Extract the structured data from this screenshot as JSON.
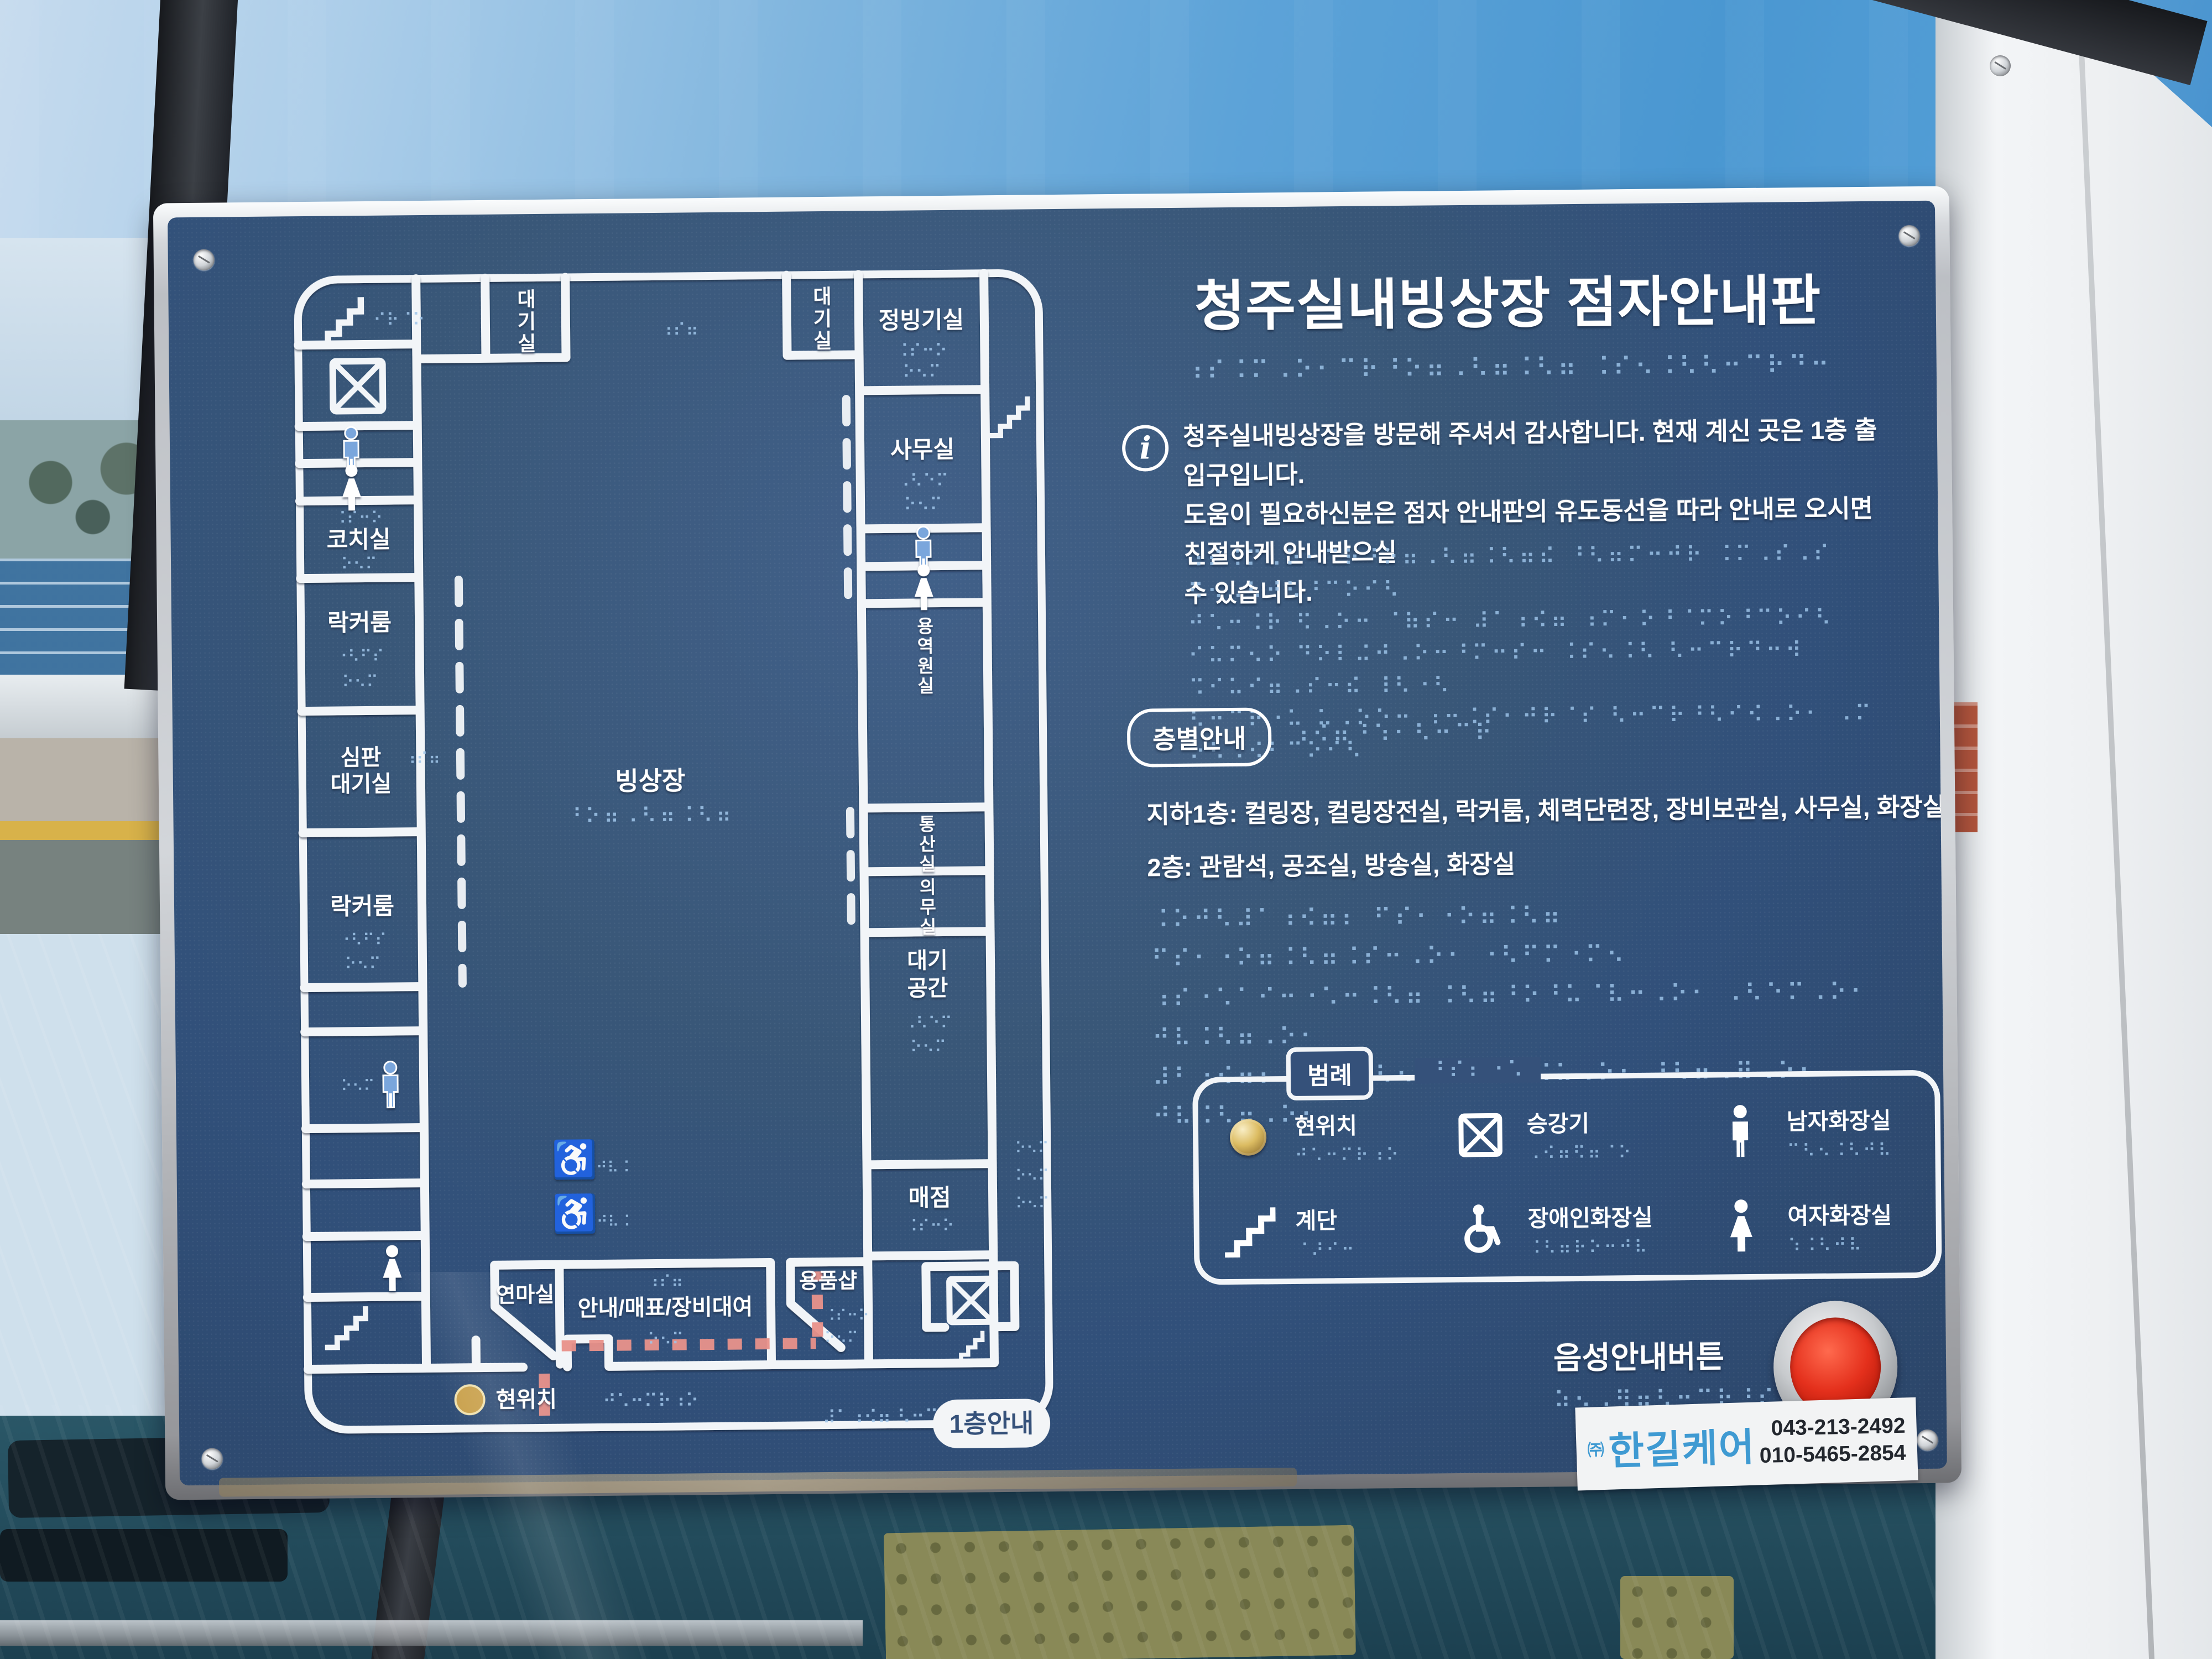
{
  "colors": {
    "panel_navy": "#35517a",
    "wall_white": "#f2f5f8",
    "braille_blue": "#9cc2e8",
    "path_pink": "#e8918a",
    "button_red": "#d92615",
    "gold": "#caa24e",
    "sticker_blue": "#3f9ad2"
  },
  "board": {
    "title": "청주실내빙상장 점자안내판",
    "title_braille": "⠰⠎⠨⠍⠠⠕⠂⠉⠗⠘⠕⠶⠠⠣⠶⠨⠣⠶ ⠨⠎⠢⠨⠣⠣⠒⠉⠗⠙⠒",
    "info": {
      "line1": "청주실내빙상장을 방문해 주셔서 감사합니다. 현재 계신 곳은 1층 출입구입니다.",
      "line2": "도움이 필요하신분은 점자 안내판의 유도동선을 따라 안내로 오시면 친절하게 안내받으실",
      "line3": "수 있습니다.",
      "braille1": "⠰⠎⠨⠍⠠⠕⠂⠉⠗⠘⠕⠶⠠⠣⠶⠨⠣⠶⠮ ⠘⠣⠶⠍⠒⠚⠗ ⠨⠍⠠⠎⠠⠎ ⠫⠢⠠⠣⠚⠣⠘⠉⠕⠊⠣",
      "braille2": "⠚⠡⠒⠨⠗ ⠫⠠⠕⠒ ⠈⠷⠎⠒ ⠼⠁⠰⠪⠶ ⠰⠍⠂⠕⠘⠈⠍⠕⠘⠉⠕⠊⠣",
      "braille3": "⠊⠥⠍⠢⠕ ⠙⠕⠇⠬⠚⠠⠕⠒⠘⠍⠒⠎⠒ ⠨⠎⠢⠨⠣ ⠣⠒⠉⠗⠙⠒⠺ ⠩⠊⠥⠊⠶⠠⠎⠒⠮ ⠸⠣⠐⠣",
      "braille4": "⠣⠒⠉⠗⠐⠥ ⠥⠠⠕⠑⠒ ⠰⠒⠨⠎⠂⠚⠗⠈⠎ ⠣⠒⠉⠗⠘⠣⠊⠪⠠⠕⠂ ⠠⠍ ⠕⠣⠠⠪⠃⠉⠕⠊⠣"
    },
    "floors": {
      "pill": "층별안내",
      "pill_braille": "⠰⠪⠶⠘⠱⠂⠣⠒⠉⠗",
      "line1": "지하1층: 컬링장, 컬링장전실, 락커룸, 체력단련장, 장비보관실, 사무실, 화장실",
      "line2": "2층: 관람석, 공조실, 방송실, 화장실",
      "braille1": "⠨⠕⠚⠣⠼⠁⠰⠪⠶⠆ ⠋⠎⠂⠐⠕⠶⠨⠣⠶ ⠋⠎⠂⠐⠕⠶⠨⠣⠶⠨⠎⠒⠠⠕⠂ ⠐⠣⠋⠍⠐⠍⠢",
      "braille2": "⠰⠎⠐⠡⠁⠊⠒⠐⠡⠒⠨⠣⠶ ⠨⠣⠶⠘⠕⠘⠥⠈⠧⠒⠠⠕⠂ ⠠⠣⠑⠍⠠⠕⠂ ⠚⠧⠨⠣⠶⠠⠕⠂",
      "braille3": "⠼⠃⠰⠪⠶⠆ ⠈⠧⠒⠐⠣⠢⠠⠎⠁ ⠈⠿⠨⠥⠠⠕⠂ ⠘⠣⠶⠠⠿⠠⠕⠂ ⠚⠧⠨⠣⠶⠠⠕⠂"
    },
    "legend": {
      "title": "범례",
      "title_braille": "⠘⠎⠆⠐⠡",
      "items": [
        {
          "icon": "current-location-button",
          "label": "현위치",
          "braille": "⠚⠡⠒⠍⠗⠰⠕"
        },
        {
          "icon": "elevator-icon",
          "label": "승강기",
          "braille": "⠠⠪⠶⠫⠶⠈⠕"
        },
        {
          "icon": "male-restroom-icon",
          "label": "남자화장실",
          "braille": "⠉⠣⠢⠨⠣⠚⠧"
        },
        {
          "icon": "stairs-icon",
          "label": "계단",
          "braille": "⠈⠜⠊⠒"
        },
        {
          "icon": "accessible-restroom-icon",
          "label": "장애인화장실",
          "braille": "⠨⠣⠶⠗⠕⠒⠚⠧"
        },
        {
          "icon": "female-restroom-icon",
          "label": "여자화장실",
          "braille": "⠱⠨⠣⠚⠧"
        }
      ]
    },
    "voice": {
      "label": "음성안내버튼",
      "braille": "⠵⠢⠠⠻⠶⠣⠒⠉⠗⠘⠎⠊⠵⠒"
    },
    "sticker": {
      "prefix": "㈜",
      "company": "한길케어",
      "phone1": "043-213-2492",
      "phone2": "010-5465-2854"
    }
  },
  "map": {
    "pill": "1층안내",
    "current": "현위치",
    "current_braille": "⠚⠡⠒⠍⠗⠰⠕",
    "bottom_braille": "⠼⠁⠰⠪⠶ ⠣⠒⠉⠗ ⠊⠗⠈⠕",
    "rink": "빙상장",
    "rink_braille": "⠘⠕⠶⠠⠣⠶⠨⠣⠶",
    "labels": {
      "waiting1": "대기실",
      "waiting2": "대기실",
      "resurfacing": "정빙기실",
      "office": "사무실",
      "coach": "코치실",
      "locker1": "락커룸",
      "referee1": "심판",
      "referee2": "대기실",
      "locker2": "락커룸",
      "service": "용역원실",
      "comms": "통산실",
      "medical": "의무실",
      "wait1": "대기",
      "wait2": "공간",
      "snack": "매점",
      "shop": "용품샵",
      "grinding": "연마실",
      "infodesk": "안내/매표/장비대여"
    },
    "braille": {
      "a": "⠨⠎⠒⠕",
      "b": "⠐⠣⠋⠎",
      "c": "⠠⠣⠑⠍",
      "d": "⠚⠧⠨",
      "e": "⠊⠗⠈⠕",
      "f": "⠰⠎⠶",
      "g": "⠕⠢⠍"
    }
  }
}
